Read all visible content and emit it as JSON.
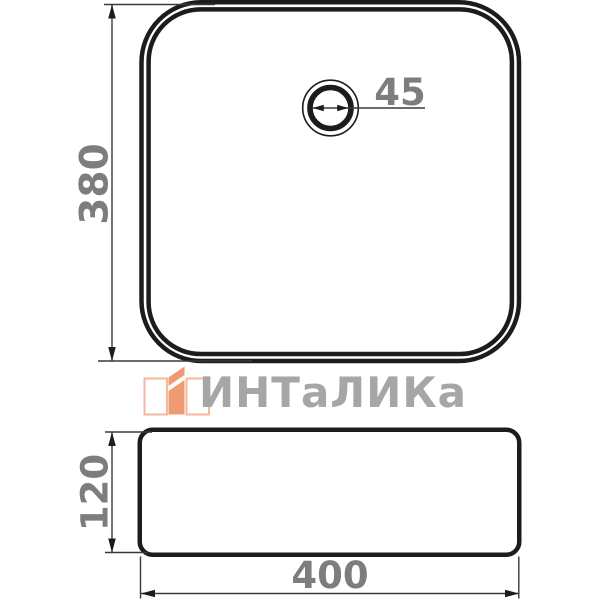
{
  "drawing": {
    "type": "technical-dimension-diagram",
    "subject": "square countertop sink, top view and side view",
    "background": "#ffffff",
    "colors": {
      "outline": "#1c1c1c",
      "dimension_lines": "#3a3a3a",
      "dimension_text": "#7d7d7d",
      "watermark_text": "#a6a6a6",
      "logo_orange": "#ef9a70",
      "logo_outline_peach": "#f4b89d"
    }
  },
  "dimensions": {
    "top_view_height": "380",
    "drain_diameter": "45",
    "side_view_height": "120",
    "side_view_width": "400"
  },
  "watermark": {
    "brand": "ИНТаЛИКа",
    "logo_icon": "intalika-logo-icon"
  }
}
